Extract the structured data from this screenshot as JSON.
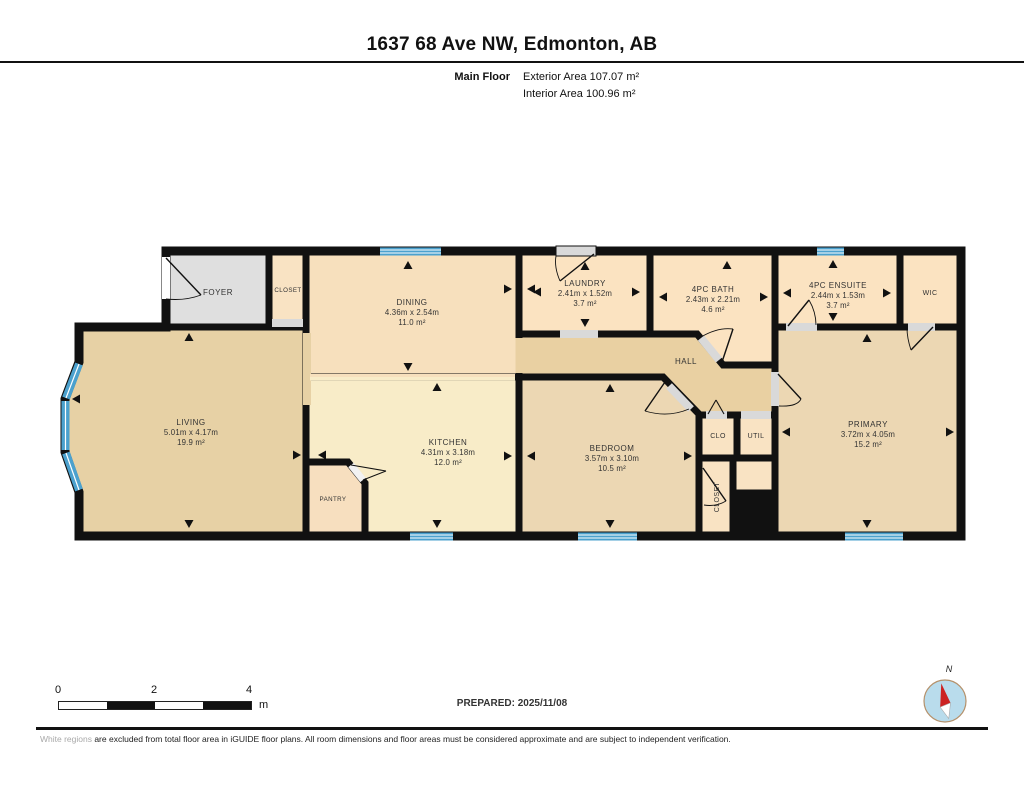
{
  "header": {
    "title": "1637 68 Ave NW, Edmonton, AB",
    "floor_label": "Main Floor",
    "exterior_area": "Exterior Area 107.07 m²",
    "interior_area": "Interior Area 100.96 m²"
  },
  "rooms": {
    "living": {
      "name": "LIVING",
      "dims": "5.01m x 4.17m",
      "area": "19.9 m²"
    },
    "dining": {
      "name": "DINING",
      "dims": "4.36m x 2.54m",
      "area": "11.0 m²"
    },
    "kitchen": {
      "name": "KITCHEN",
      "dims": "4.31m x 3.18m",
      "area": "12.0 m²"
    },
    "foyer": {
      "name": "FOYER"
    },
    "foyer_closet": {
      "name": "CLOSET"
    },
    "pantry": {
      "name": "PANTRY"
    },
    "laundry": {
      "name": "LAUNDRY",
      "dims": "2.41m x 1.52m",
      "area": "3.7 m²"
    },
    "bath": {
      "name": "4PC BATH",
      "dims": "2.43m x 2.21m",
      "area": "4.6 m²"
    },
    "ensuite": {
      "name": "4PC ENSUITE",
      "dims": "2.44m x 1.53m",
      "area": "3.7 m²"
    },
    "wic": {
      "name": "WIC"
    },
    "hall": {
      "name": "HALL"
    },
    "bedroom": {
      "name": "BEDROOM",
      "dims": "3.57m x 3.10m",
      "area": "10.5 m²"
    },
    "clo": {
      "name": "CLO"
    },
    "util": {
      "name": "UTIL"
    },
    "bedroom_closet": {
      "name": "CLOSET"
    },
    "primary": {
      "name": "PRIMARY",
      "dims": "3.72m x 4.05m",
      "area": "15.2 m²"
    }
  },
  "scale_bar": {
    "tick0": "0",
    "tick2": "2",
    "tick4": "4",
    "unit": "m"
  },
  "compass": {
    "north_label": "N"
  },
  "footer": {
    "prepared": "PREPARED: 2025/11/08",
    "disclaimer_highlight": "White regions",
    "disclaimer_rest": " are excluded from total floor area in iGUIDE floor plans. All room dimensions and floor areas must be considered approximate and are subject to independent verification."
  },
  "colors": {
    "wall": "#111111",
    "window_blue": "#4ba1ce",
    "floor_tan": "#e7d1a5",
    "floor_peach": "#fbe3c1",
    "floor_cream": "#f8ecc8",
    "foyer_gray": "#dfdfdf",
    "compass_red": "#cc2222"
  }
}
